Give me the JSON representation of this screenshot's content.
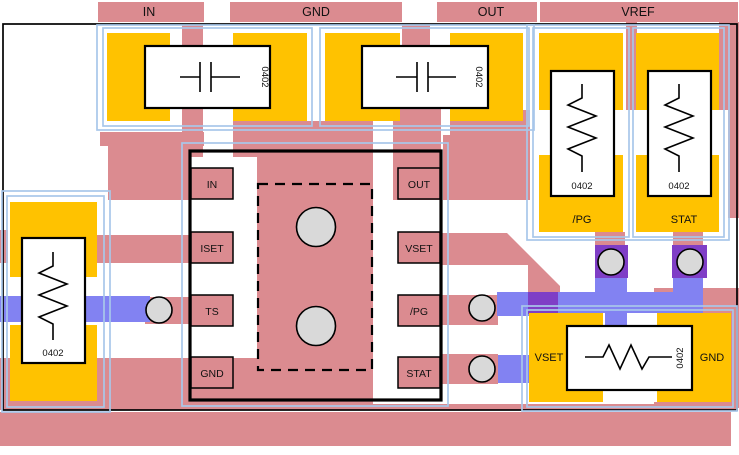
{
  "net_labels": {
    "in": "IN",
    "gnd": "GND",
    "out": "OUT",
    "vref": "VREF"
  },
  "ic": {
    "left_pins": [
      "IN",
      "ISET",
      "TS",
      "GND"
    ],
    "right_pins": [
      "OUT",
      "VSET",
      "/PG",
      "STAT"
    ]
  },
  "components": {
    "cap_in": {
      "size_label": "0402"
    },
    "cap_out": {
      "size_label": "0402"
    },
    "res_pg": {
      "size_label": "0402",
      "pad_label": "/PG"
    },
    "res_stat": {
      "size_label": "0402",
      "pad_label": "STAT"
    },
    "res_left": {
      "size_label": "0402"
    },
    "res_bottom": {
      "size_label": "0402",
      "left_pad_label": "VSET",
      "right_pad_label": "GND"
    }
  },
  "colors": {
    "copper_pour": "#DB8B90",
    "pad": "#FFC200",
    "bottom_trace": "#8282F2",
    "via_overlap": "#7F3EC6",
    "via_fill": "#D9D9D9",
    "courtyard": "#A8C7EA",
    "silkscreen": "#000000"
  }
}
